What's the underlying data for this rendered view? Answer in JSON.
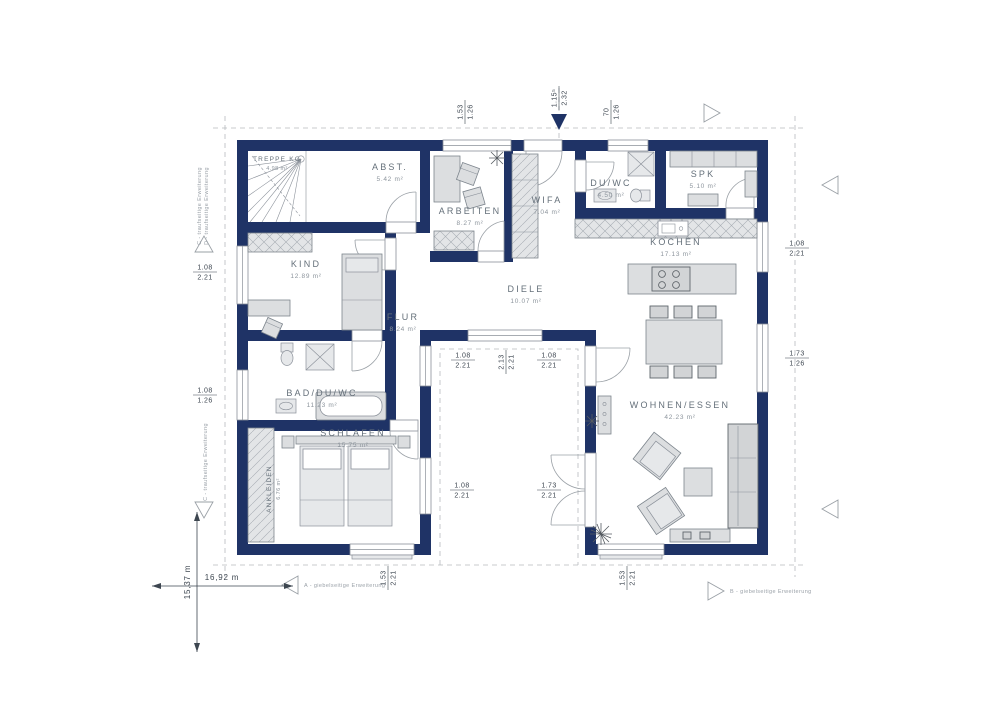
{
  "rooms": [
    {
      "id": "treppe-kg",
      "name": "TREPPE KG",
      "area": "4.98 m²"
    },
    {
      "id": "abstell",
      "name": "ABST.",
      "area": "5.42 m²"
    },
    {
      "id": "arbeiten",
      "name": "ARBEITEN",
      "area": "8.27 m²"
    },
    {
      "id": "wifa",
      "name": "WIFA",
      "area": "7.04 m²"
    },
    {
      "id": "du-wc",
      "name": "DU/WC",
      "area": "4.50 m²"
    },
    {
      "id": "spk",
      "name": "SPK",
      "area": "5.10 m²"
    },
    {
      "id": "kochen",
      "name": "KOCHEN",
      "area": "17.13 m²"
    },
    {
      "id": "kind",
      "name": "KIND",
      "area": "12.89 m²"
    },
    {
      "id": "diele",
      "name": "DIELE",
      "area": "10.07 m²"
    },
    {
      "id": "flur",
      "name": "FLUR",
      "area": "8.24 m²"
    },
    {
      "id": "bad-du-wc",
      "name": "BAD/DU/WC",
      "area": "11.23 m²"
    },
    {
      "id": "schlafen",
      "name": "SCHLAFEN",
      "area": "15.75 m²"
    },
    {
      "id": "ankleiden",
      "name": "ANKLEIDEN",
      "area": "6.76 m²"
    },
    {
      "id": "wohnen-essen",
      "name": "WOHNEN/ESSEN",
      "area": "42.23 m²"
    }
  ],
  "dims": [
    {
      "w": "1.53",
      "h": "1.26"
    },
    {
      "w": "1.15⁵",
      "h": "2.32"
    },
    {
      "w": "70",
      "h": "1.26"
    },
    {
      "w": "1.08",
      "h": "2.21"
    },
    {
      "w": "1.08",
      "h": "1.26"
    },
    {
      "w": "1.08",
      "h": "2.21"
    },
    {
      "w": "1.73",
      "h": "1.26"
    },
    {
      "w": "1.08",
      "h": "2.21"
    },
    {
      "w": "2.13",
      "h": "2.21"
    },
    {
      "w": "1.08",
      "h": "2.21"
    },
    {
      "w": "1.08",
      "h": "2.21"
    },
    {
      "w": "1.73",
      "h": "2.21"
    },
    {
      "w": "1.53",
      "h": "2.21"
    },
    {
      "w": "1.53",
      "h": "2.21"
    }
  ],
  "scale": {
    "width": "16,92 m",
    "height": "15,37 m"
  },
  "annotations": {
    "a": "A - giebelseitige Erweiterung",
    "b": "B - giebelseitige Erweiterung",
    "c": "C - traufseitige Erweiterung",
    "d": "D - traufseitige Erweiterung"
  },
  "colors": {
    "wall": "#1f3366",
    "furniture": "#dcdee0",
    "boundary": "#b6babf",
    "accent": "#1f3366"
  }
}
